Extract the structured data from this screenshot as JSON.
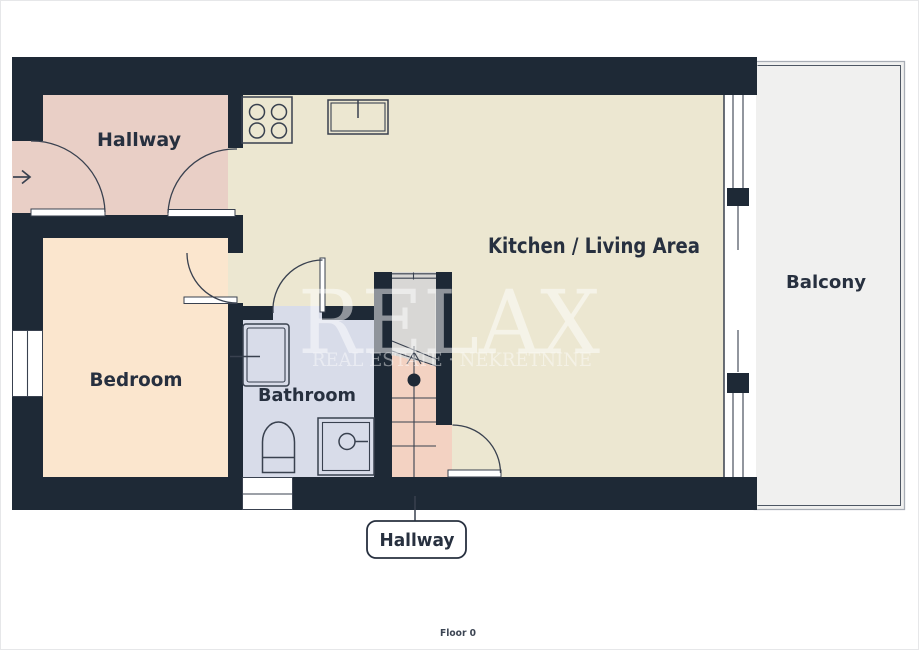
{
  "page": {
    "floor_label": "Floor 0"
  },
  "rooms": {
    "hallway": {
      "label": "Hallway"
    },
    "kitchen_living": {
      "label": "Kitchen / Living Area"
    },
    "bedroom": {
      "label": "Bedroom"
    },
    "bathroom": {
      "label": "Bathroom"
    },
    "balcony": {
      "label": "Balcony"
    },
    "hallway_lower": {
      "label": "Hallway"
    }
  },
  "watermark": {
    "brand": "RELAX",
    "tagline": "REAL ESTATE · NEKRETNINE"
  },
  "icons": {
    "entry_arrow": "entry direction arrow →",
    "stove": "4-burner cooktop",
    "kitchen_sink": "kitchen sink with tap",
    "bathroom_sink": "wash basin",
    "toilet": "toilet",
    "shower": "shower tray with drain",
    "stairs_arrow": "stairs going up arrow"
  },
  "colors": {
    "wall": "#1e2936",
    "hallway": "#e9cfc6",
    "bedroom": "#fbe6ce",
    "kitchen": "#ece7d1",
    "bathroom": "#d8dce9",
    "stairs_upper": "#d8d7d5",
    "stairs_lower": "#f3d2c2",
    "balcony": "#f0f0ef",
    "line": "#39414f",
    "label": "#27303f",
    "floor_label": "#3c4553"
  }
}
